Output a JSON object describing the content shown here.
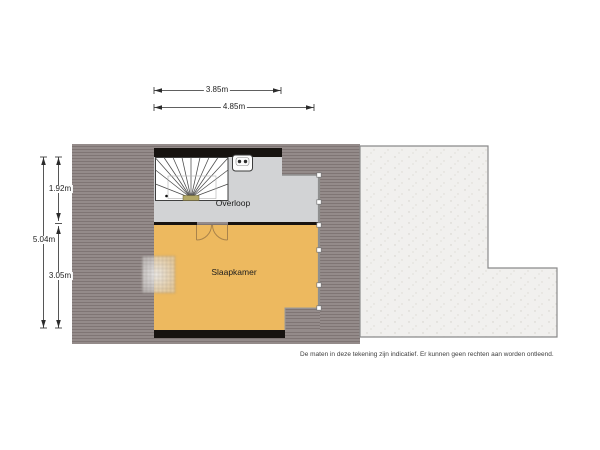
{
  "plan": {
    "type": "floorplan-second-floor",
    "rooms": [
      {
        "id": "overloop",
        "label": "Overloop"
      },
      {
        "id": "slaapkamer",
        "label": "Slaapkamer"
      }
    ],
    "dimensions": {
      "top": [
        {
          "id": "width-overloop",
          "label": "3.85m"
        },
        {
          "id": "width-total",
          "label": "4.85m"
        }
      ],
      "left": [
        {
          "id": "depth-overloop",
          "label": "1.92m"
        },
        {
          "id": "depth-total",
          "label": "5.04m"
        },
        {
          "id": "depth-slaapkamer",
          "label": "3.05m"
        }
      ]
    },
    "fixtures": [
      {
        "icon": "staircase-icon",
        "meaning": "winder staircase"
      },
      {
        "icon": "ventilation-unit-icon",
        "meaning": "mechanical ventilation unit"
      },
      {
        "icon": "double-door-icon",
        "meaning": "double swing door"
      },
      {
        "icon": "roof-window-icon",
        "meaning": "roof window / skylight"
      }
    ],
    "disclaimer": "De maten in deze tekening zijn indicatief. Er kunnen geen rechten aan worden ontleend.",
    "colors": {
      "roof_stripe_light": "#948b8a",
      "roof_stripe_dark": "#7f7574",
      "wall_black": "#171310",
      "floor_overloop": "#d2d3d5",
      "floor_slaapkamer": "#edb95f",
      "flat_roof": "#f1f0ee",
      "flat_roof_border": "#8a8a8a",
      "dimension_line": "#2b2b2b",
      "door_swing": "#a9834b"
    }
  }
}
